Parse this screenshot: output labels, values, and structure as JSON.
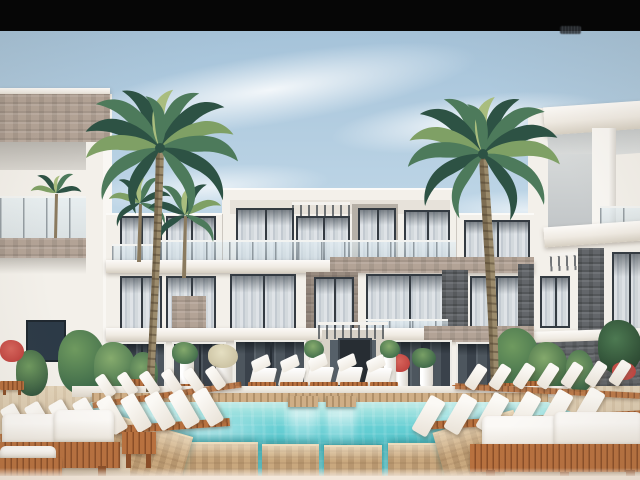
{
  "scene": {
    "type": "architectural-rendering",
    "description": "Daytime 3D exterior rendering of a modern white three-storey resort apartment complex with glass-railing balconies and stone-clad accents, two tall palm trees, landscaped courtyard with potted plants, rows of white-cushioned timber sun loungers, small timber pool benches, and a turquoise swimming pool with timber swim platforms in the foreground; black letterbox bar across the top",
    "time_of_day": "day",
    "sky": "light blue with thin wispy clouds",
    "visible_text": "none (only an illegible dark smudge at the top-right edge of the black bar)"
  },
  "palette": {
    "black_bar": "#060606",
    "sky_top": "#a3c1d8",
    "sky_mid": "#bdd5e6",
    "sky_low": "#d3e2ec",
    "wall_white": "#f3f0ea",
    "wall_shade": "#e2dcd2",
    "stone_warm": "#b3a396",
    "stone_gray": "#63666a",
    "frame_dark": "#343b42",
    "glass_curtain_a": "#dfe3e7",
    "glass_curtain_b": "#c3cad1",
    "glass_door_a": "#4d565e",
    "glass_door_b": "#3a424b",
    "pool_far": "#cdeeea",
    "pool_mid": "#66cfd4",
    "pool_deep": "#57c8ce",
    "pool_front": "#8fdcdd",
    "deck_sand": "#d8c6ab",
    "wood_warm": "#b8713f",
    "wood_dark": "#8a4e28",
    "wood_cap": "#cfae86",
    "wood_platform": "#c9a87e",
    "cushion_white": "#f6f3ee",
    "palm_dark": "#2d5244",
    "palm_mid": "#4d7a5b",
    "palm_light": "#7fa065",
    "palm_pale": "#a9bd7e",
    "trunk_light": "#9b8b6c",
    "trunk_dark": "#71614a",
    "plant_dark": "#3f6b4a",
    "plant_light": "#6f9a5f",
    "flower_red": "#c04440",
    "haze": "#f3e7da"
  },
  "objects": {
    "buildings": [
      "left-wing-building",
      "central-apartment-block",
      "right-wing-building"
    ],
    "vegetation": [
      "tall-palm-left",
      "tall-palm-right",
      "background-small-palms",
      "courtyard-shrubs",
      "potted-plants",
      "red-flowering-shrubs"
    ],
    "pool_area": [
      "swimming-pool",
      "timber-swim-platforms",
      "pool-edge-timber-cap",
      "pool-bridges",
      "pool-benches",
      "white-pool-chairs",
      "sun-lounger-rows",
      "timber-double-loungers",
      "sand-colored-deck"
    ]
  }
}
